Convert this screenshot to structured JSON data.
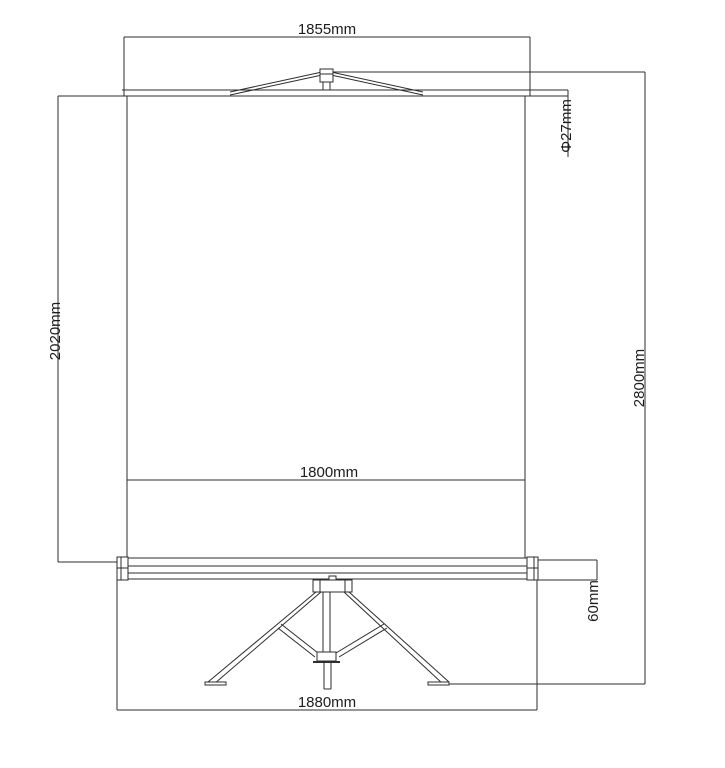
{
  "drawing": {
    "type": "technical-dimension-drawing",
    "subject": "tripod projection screen front elevation",
    "background_color": "#ffffff",
    "line_color": "#2e2e2e",
    "text_color": "#1c1c1c",
    "dimensions": {
      "top_width": "1855mm",
      "tube_diameter": "Φ27mm",
      "screen_drop_height": "2020mm",
      "total_height": "2800mm",
      "viewing_width": "1800mm",
      "case_height": "60mm",
      "base_width": "1880mm"
    }
  }
}
